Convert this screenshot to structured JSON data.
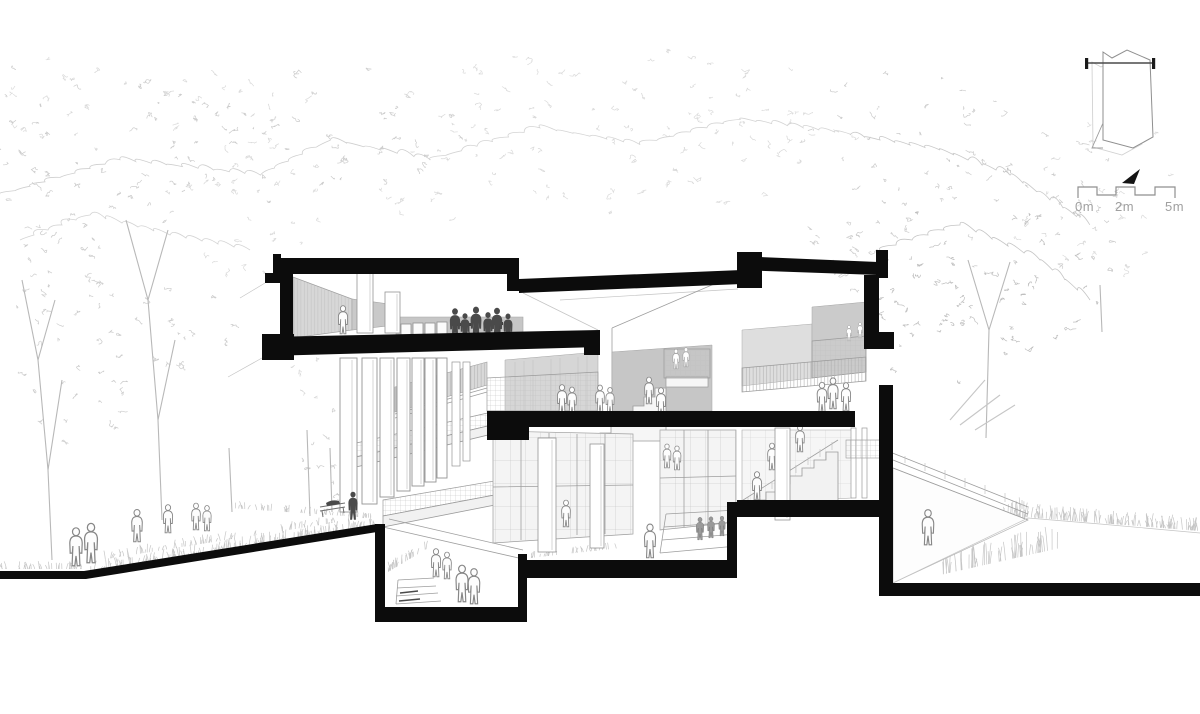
{
  "drawing": {
    "kind": "architectural-sectional-perspective",
    "scale_bar": {
      "labels": [
        "0m",
        "2m",
        "5m"
      ]
    },
    "colors": {
      "paper": "#ffffff",
      "poche": "#0c0c0c",
      "wall_gray": "#cbcbcb",
      "line_gray": "#9e9e9e",
      "foliage_gray": "#cdcdcd",
      "label_gray": "#a0a0a0"
    },
    "icons": {
      "key_plan": "site-key-plan-outline",
      "north_arrow": "north-arrow-triangle",
      "scale_bar": "graphic-scale-bar"
    }
  }
}
